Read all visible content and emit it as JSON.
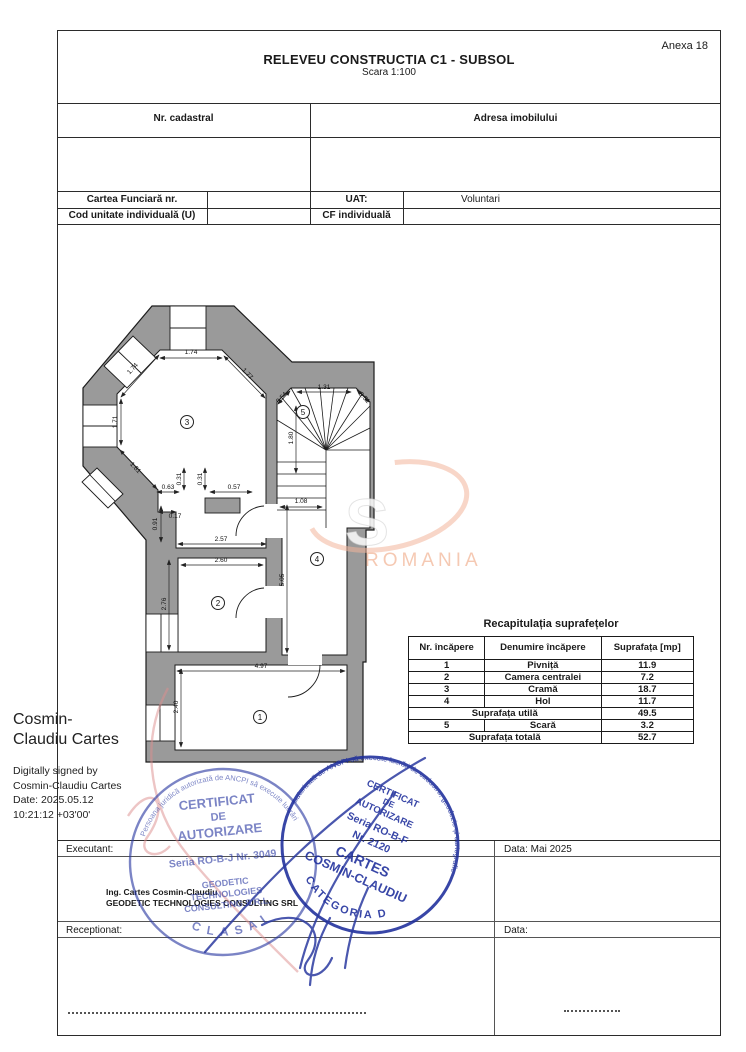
{
  "page": {
    "anexa": "Anexa 18",
    "title": "RELEVEU CONSTRUCTIA C1 - SUBSOL",
    "scale": "Scara 1:100"
  },
  "header_table": {
    "nr_cadastral": "Nr. cadastral",
    "adresa": "Adresa imobilului",
    "cartea_funciara": "Cartea Funciară  nr.",
    "uat_label": "UAT:",
    "uat_value": "Voluntari",
    "cod_unitate": "Cod unitate individuală (U)",
    "cf_individuala": "CF individuală"
  },
  "plan": {
    "wall_color": "#9a9a9a",
    "room_labels": [
      {
        "n": "3",
        "x": 187,
        "y": 422
      },
      {
        "n": "5",
        "x": 303,
        "y": 412
      },
      {
        "n": "2",
        "x": 218,
        "y": 603
      },
      {
        "n": "4",
        "x": 317,
        "y": 559
      },
      {
        "n": "1",
        "x": 260,
        "y": 717
      }
    ],
    "dimensions": [
      {
        "t": "1.74",
        "x": 191,
        "y": 354,
        "r": 0,
        "line": [
          160,
          358,
          222,
          358
        ]
      },
      {
        "t": "1.74",
        "x": 134,
        "y": 370,
        "r": -47,
        "line": [
          121,
          397,
          159,
          355
        ]
      },
      {
        "t": "1.77",
        "x": 246,
        "y": 375,
        "r": 47,
        "line": [
          224,
          356,
          265,
          398
        ]
      },
      {
        "t": "1.71",
        "x": 117,
        "y": 422,
        "r": -90,
        "line": [
          121,
          399,
          121,
          445
        ]
      },
      {
        "t": "1.81",
        "x": 134,
        "y": 469,
        "r": 47,
        "line": [
          120,
          450,
          157,
          489
        ]
      },
      {
        "t": "0.63",
        "x": 168,
        "y": 489,
        "r": 0,
        "line": [
          157,
          492,
          179,
          492
        ]
      },
      {
        "t": "0.31",
        "x": 181,
        "y": 479,
        "r": -90,
        "line": [
          184,
          468,
          184,
          490
        ]
      },
      {
        "t": "0.31",
        "x": 202,
        "y": 479,
        "r": -90,
        "line": [
          205,
          468,
          205,
          490
        ]
      },
      {
        "t": "0.57",
        "x": 234,
        "y": 489,
        "r": 0,
        "line": [
          210,
          492,
          252,
          492
        ]
      },
      {
        "t": "0.17",
        "x": 175,
        "y": 518,
        "r": 0,
        "line": [
          158,
          512,
          176,
          512
        ]
      },
      {
        "t": "0.91",
        "x": 157,
        "y": 524,
        "r": -90,
        "line": [
          161,
          506,
          161,
          542
        ]
      },
      {
        "t": "2.57",
        "x": 221,
        "y": 541,
        "r": 0,
        "line": [
          178,
          544,
          266,
          544
        ]
      },
      {
        "t": "2.60",
        "x": 221,
        "y": 562,
        "r": 0,
        "line": [
          181,
          565,
          263,
          565
        ]
      },
      {
        "t": "2.76",
        "x": 166,
        "y": 604,
        "r": -90,
        "line": [
          169,
          560,
          169,
          650
        ]
      },
      {
        "t": "5.05",
        "x": 284,
        "y": 580,
        "r": -90,
        "line": [
          287,
          505,
          287,
          653
        ]
      },
      {
        "t": "4.97",
        "x": 261,
        "y": 668,
        "r": 0,
        "line": [
          177,
          671,
          345,
          671
        ]
      },
      {
        "t": "2.40",
        "x": 178,
        "y": 707,
        "r": -90,
        "line": [
          181,
          669,
          181,
          747
        ]
      },
      {
        "t": "0.54",
        "x": 283,
        "y": 399,
        "r": -46,
        "line": [
          278,
          404,
          290,
          391
        ]
      },
      {
        "t": "1.31",
        "x": 324,
        "y": 389,
        "r": 0,
        "line": [
          297,
          392,
          351,
          392
        ]
      },
      {
        "t": "0.51",
        "x": 363,
        "y": 399,
        "r": 46,
        "line": [
          357,
          390,
          369,
          402
        ]
      },
      {
        "t": "1.80",
        "x": 293,
        "y": 438,
        "r": -90,
        "line": [
          296,
          406,
          296,
          473
        ]
      },
      {
        "t": "1.08",
        "x": 301,
        "y": 503,
        "r": 0,
        "line": [
          280,
          507,
          322,
          507
        ]
      }
    ]
  },
  "recap_table": {
    "title": "Recapitulația suprafețelor",
    "headers": [
      "Nr. încăpere",
      "Denumire încăpere",
      "Suprafața [mp]"
    ],
    "rows": [
      {
        "nr": "1",
        "name": "Pivniță",
        "area": "11.9"
      },
      {
        "nr": "2",
        "name": "Camera centralei",
        "area": "7.2"
      },
      {
        "nr": "3",
        "name": "Cramă",
        "area": "18.7"
      },
      {
        "nr": "4",
        "name": "Hol",
        "area": "11.7"
      },
      {
        "merged": "Suprafața utilă",
        "area": "49.5"
      },
      {
        "nr": "5",
        "name": "Scară",
        "area": "3.2"
      },
      {
        "merged": "Suprafața totală",
        "area": "52.7"
      }
    ]
  },
  "signature": {
    "name_line1": "Cosmin-",
    "name_line2": "Claudiu Cartes",
    "info_lines": [
      "Digitally signed by",
      "Cosmin-Claudiu Cartes",
      "Date: 2025.05.12",
      "10:21:12 +03'00'"
    ]
  },
  "footer": {
    "executant_label": "Executant:",
    "executant_line1": "Ing. Cartes Cosmin-Claudiu",
    "executant_line2": "GEODETIC TECHNOLOGIES CONSULTING SRL",
    "receptionat_label": "Receptionat:",
    "data_executant": "Data: Mai 2025",
    "data_receptionat": "Data:"
  },
  "stamps": {
    "ink_color": "#2b3aa3",
    "left": {
      "ring_text": "Persoana juridică autorizată de ANCPI să execute lucrări",
      "lines": [
        "CERTIFICAT",
        "DE",
        "AUTORIZARE",
        "Seria RO-B-J Nr. 3049",
        "GEODETIC",
        "TECHNOLOGIES",
        "CONSULTING S.R.L."
      ],
      "bottom_text": "C L A S A  I"
    },
    "right": {
      "ring_text": "autorizată de ANCPI să execute lucrări de cadastru, geodezie și cartografie",
      "lines": [
        "CERTIFICAT",
        "DE",
        "AUTORIZARE",
        "Seria RO-B-F",
        "Nr. 2120",
        "CARTES",
        "COSMIN-CLAUDIU"
      ],
      "bottom_text": "CATEGORIA D"
    }
  },
  "watermark": {
    "letter": "S",
    "text": "ROMANIA",
    "accent_color": "#f2b49a"
  }
}
